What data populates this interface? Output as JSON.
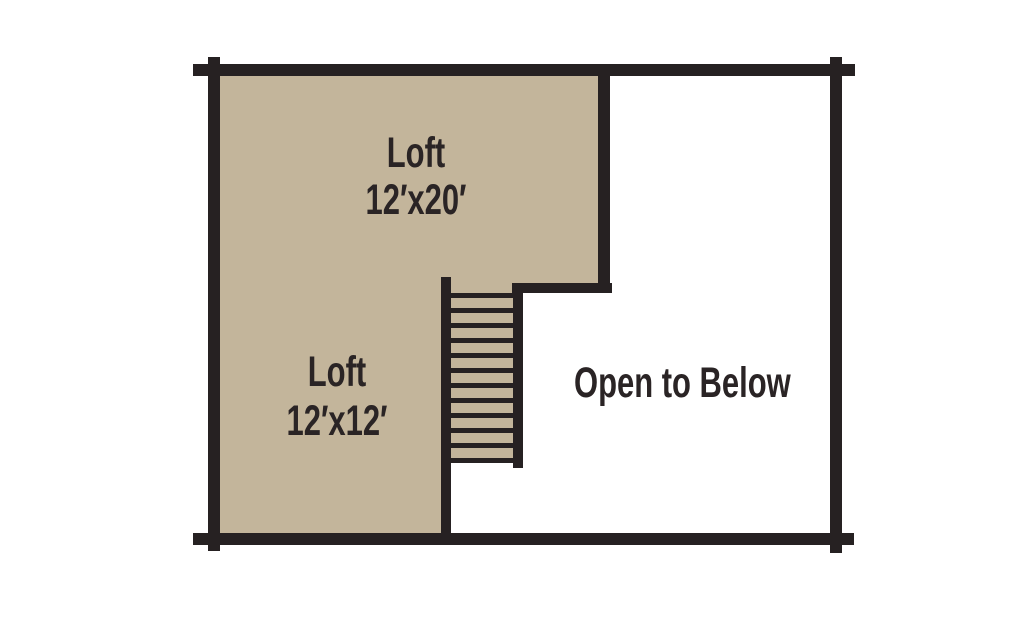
{
  "title": "Loft floor plan",
  "colors": {
    "background": "#ffffff",
    "floor_tan": "#c3b59b",
    "wall_black": "#262122",
    "text_ink": "#2a2425"
  },
  "rooms": [
    {
      "name": "loft-upper",
      "label": "Loft",
      "dimensions": "12′x20′"
    },
    {
      "name": "loft-lower",
      "label": "Loft",
      "dimensions": "12′x12′"
    },
    {
      "name": "open-to-below",
      "label": "Open to Below"
    }
  ],
  "stairs": {
    "tread_count": 12
  }
}
